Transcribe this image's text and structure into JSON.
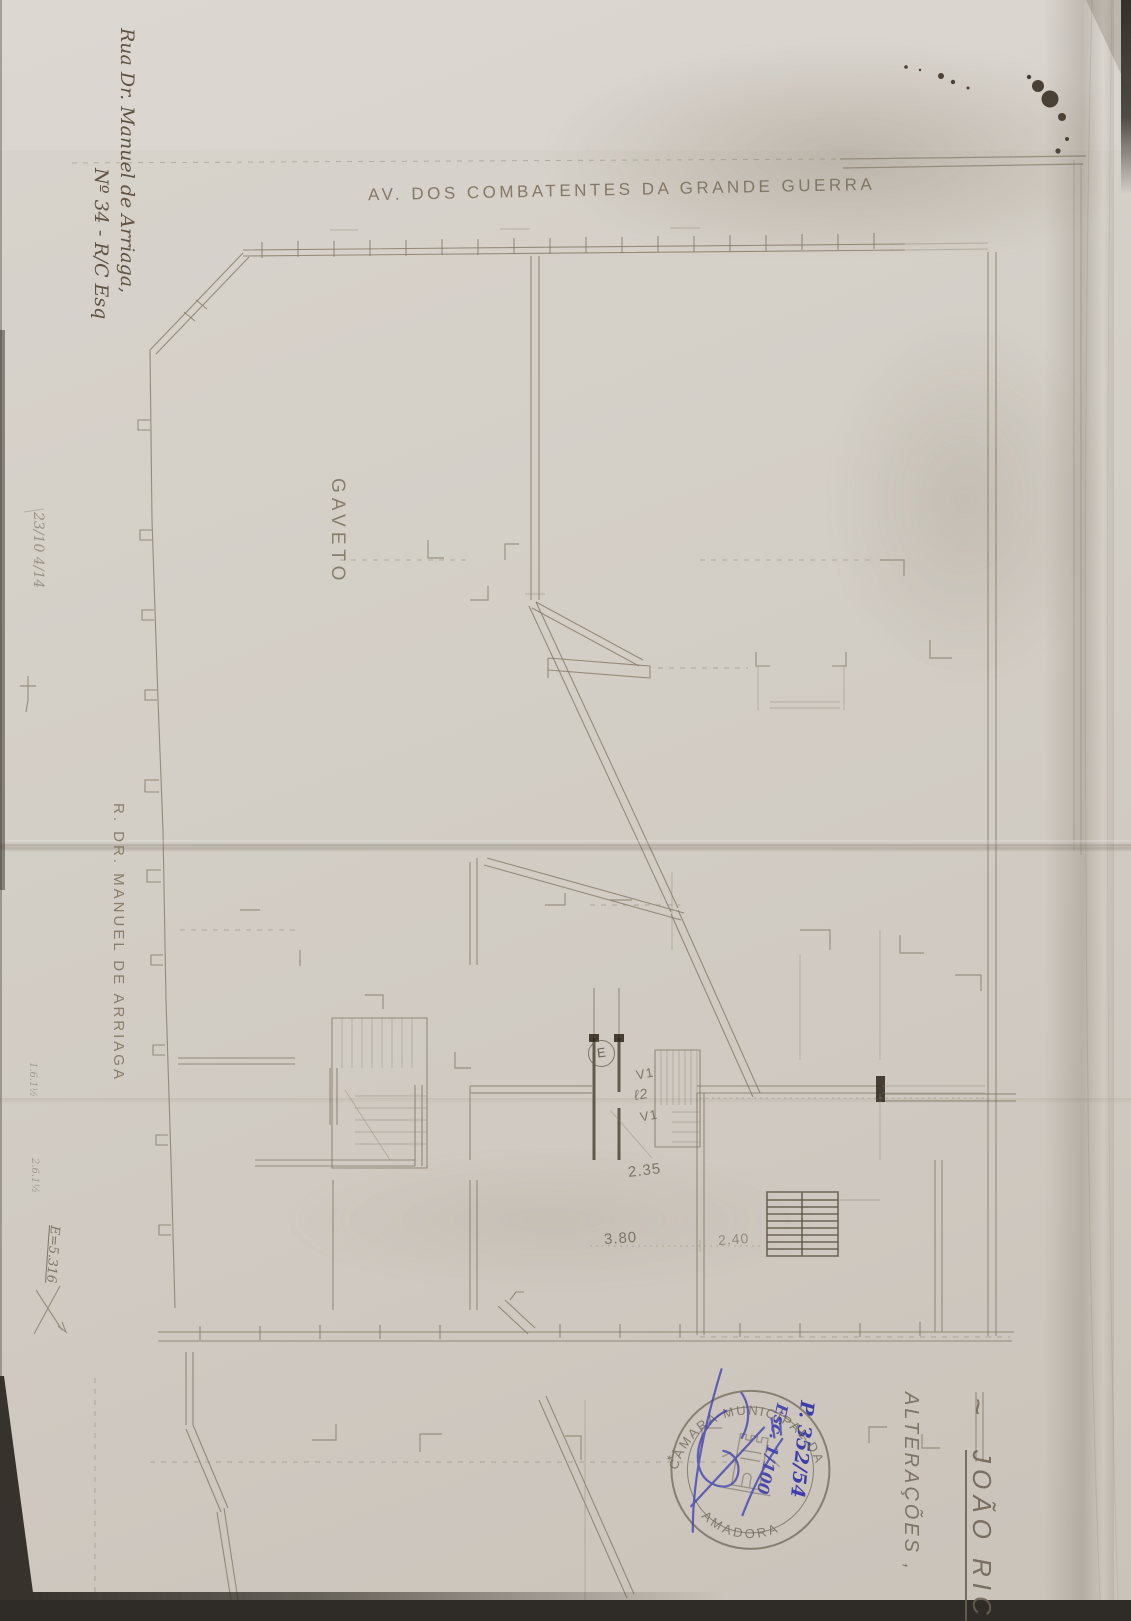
{
  "colors": {
    "paper": "#d2ccc4",
    "pencil_line": "#857969",
    "heavy_wall": "#4e453a",
    "graphite_text": "#6b6052",
    "ink_blue": "#3d3dac",
    "stamp_gray": "#6f6759",
    "ink_blot": "#32291f"
  },
  "streets": {
    "top": "AV. DOS COMBATENTES DA GRANDE GUERRA",
    "left": "R. DR. MANUEL DE ARRIAGA"
  },
  "plan": {
    "corner_label": "GAVETO",
    "entry_mark": "E",
    "window_top": "V1",
    "light_shaft": "ℓ2",
    "window_bottom": "V1",
    "dim_hall": "2.35",
    "dim_left": "3.80",
    "dim_right": "2.40"
  },
  "address": {
    "line1": "Rua Dr. Manuel de Arriaga,",
    "line2": "Nº 34 - R/C Esq"
  },
  "title_block": {
    "tilde": "~",
    "applicant": "JOÃO RIC",
    "subject": "ALTERAÇÕES ,"
  },
  "stamp": {
    "arc_top": "CÂMARA MUNICIPAL DA",
    "arc_bottom": "AMADORA",
    "star_left": "✶"
  },
  "ink_notes": {
    "process": "P. 352/54",
    "scale": "Esc. 1/100"
  },
  "pencil_notes": {
    "margin_top": "23/10 4/14",
    "margin_a": "1.6.1½",
    "margin_b": "2.6.1½",
    "margin_c": "E=5.316"
  }
}
